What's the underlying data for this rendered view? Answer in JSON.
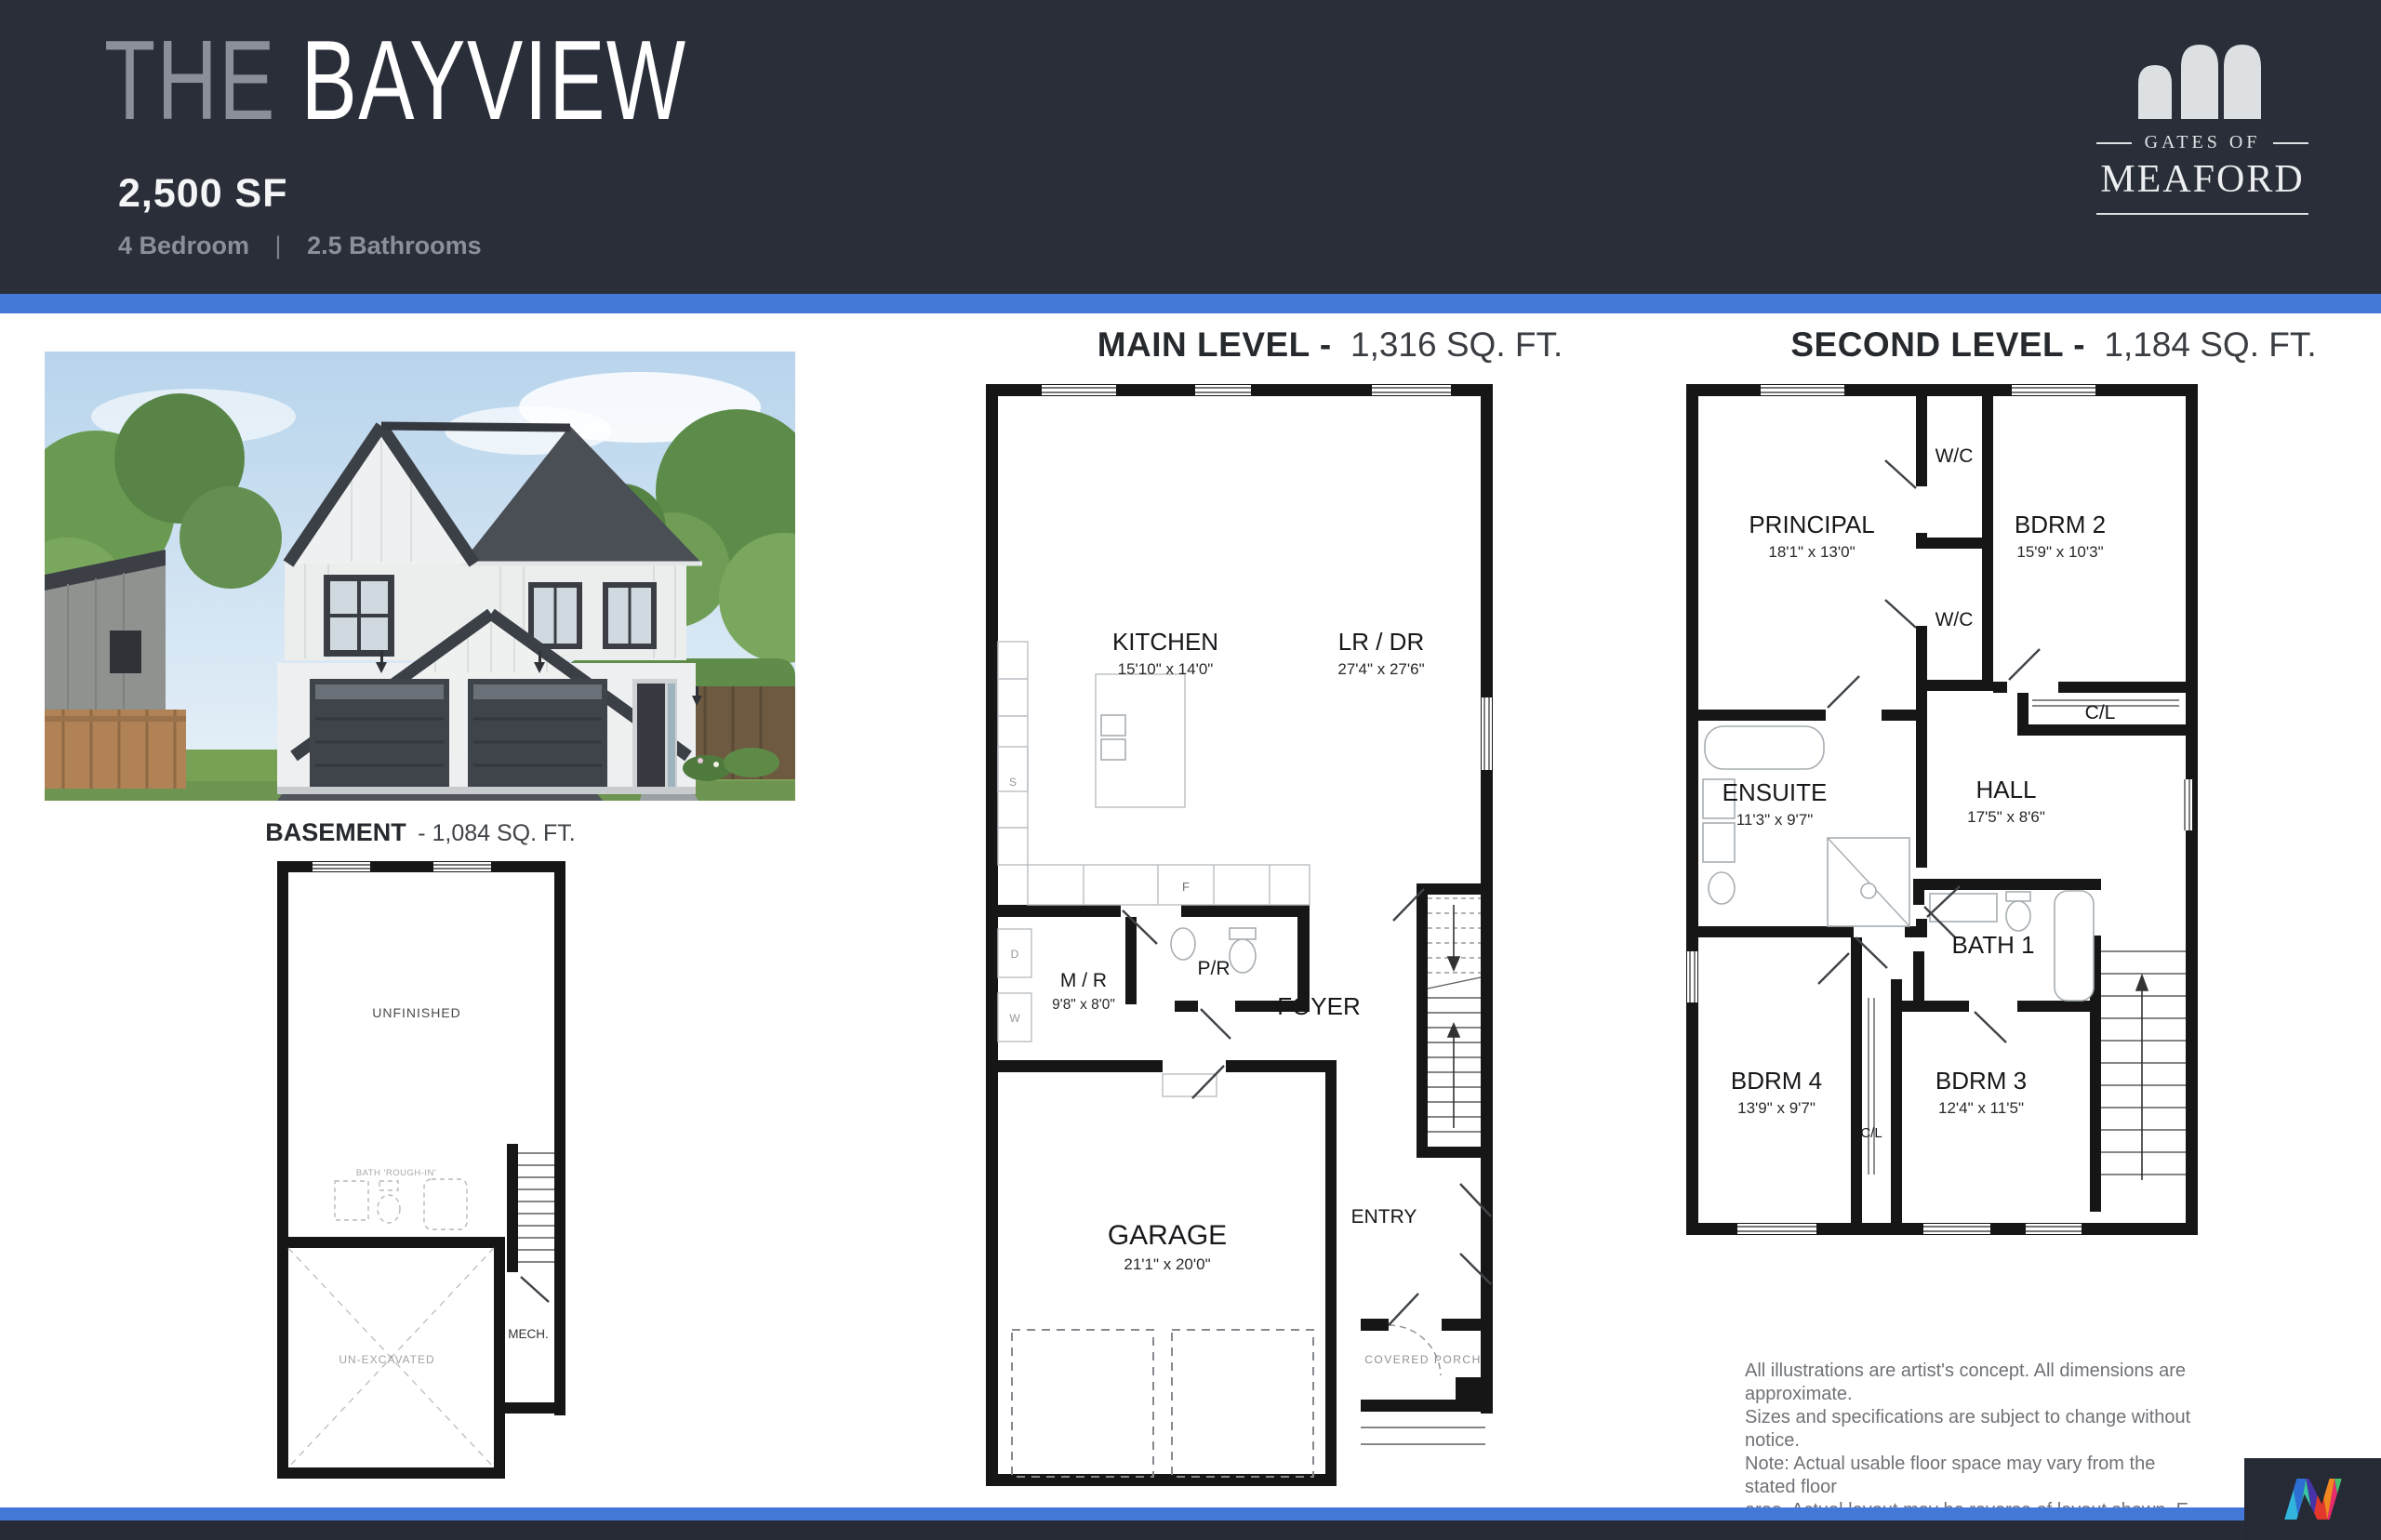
{
  "header": {
    "title_the": "THE",
    "title_name": "BAYVIEW",
    "sqft": "2,500 SF",
    "bedrooms": "4 Bedroom",
    "separator": "|",
    "bathrooms": "2.5 Bathrooms"
  },
  "brand": {
    "tagline": "GATES OF",
    "name": "MEAFORD"
  },
  "plans": {
    "basement": {
      "title": "BASEMENT",
      "sqft_suffix": "- 1,084 SQ. FT.",
      "labels": {
        "unfinished": "UNFINISHED",
        "bath_rough_in": "BATH 'ROUGH-IN'",
        "unexcavated": "UN-EXCAVATED",
        "mech": "MECH."
      }
    },
    "main": {
      "title": "MAIN LEVEL -",
      "sqft": "1,316 SQ. FT.",
      "rooms": {
        "kitchen": {
          "name": "KITCHEN",
          "dims": "15'10\" x 14'0\""
        },
        "lr_dr": {
          "name": "LR / DR",
          "dims": "27'4\" x 27'6\""
        },
        "m_r": {
          "name": "M / R",
          "dims": "9'8\" x 8'0\""
        },
        "p_r": {
          "name": "P/R"
        },
        "foyer": {
          "name": "FOYER"
        },
        "garage": {
          "name": "GARAGE",
          "dims": "21'1\" x 20'0\""
        },
        "entry": {
          "name": "ENTRY"
        },
        "covered_porch": {
          "name": "COVERED PORCH"
        }
      },
      "appliances": {
        "s": "S",
        "f": "F",
        "d": "D",
        "w": "W"
      }
    },
    "second": {
      "title": "SECOND LEVEL -",
      "sqft": "1,184 SQ. FT.",
      "rooms": {
        "principal": {
          "name": "PRINCIPAL",
          "dims": "18'1\" x 13'0\""
        },
        "wc1": {
          "name": "W/C"
        },
        "wc2": {
          "name": "W/C"
        },
        "bdrm2": {
          "name": "BDRM 2",
          "dims": "15'9\" x 10'3\""
        },
        "cl1": {
          "name": "C/L"
        },
        "ensuite": {
          "name": "ENSUITE",
          "dims": "11'3\" x 9'7\""
        },
        "hall": {
          "name": "HALL",
          "dims": "17'5\" x 8'6\""
        },
        "bath1": {
          "name": "BATH 1"
        },
        "bdrm4": {
          "name": "BDRM 4",
          "dims": "13'9\" x 9'7\""
        },
        "cl2": {
          "name": "C/L"
        },
        "bdrm3": {
          "name": "BDRM 3",
          "dims": "12'4\" x 11'5\""
        }
      }
    }
  },
  "disclaimer": {
    "lines": [
      "All illustrations are artist's concept. All dimensions are approximate.",
      "Sizes and specifications are subject to change without notice.",
      "Note: Actual usable floor space may vary from the stated floor",
      "area. Actual layout may be reverse of layout shown. E. & O. E."
    ]
  },
  "colors": {
    "header_bg": "#2a2e39",
    "accent_blue": "#4478d8",
    "footer_bg": "#272b36",
    "title_muted": "#8b8f97",
    "plan_wall": "#161616"
  }
}
